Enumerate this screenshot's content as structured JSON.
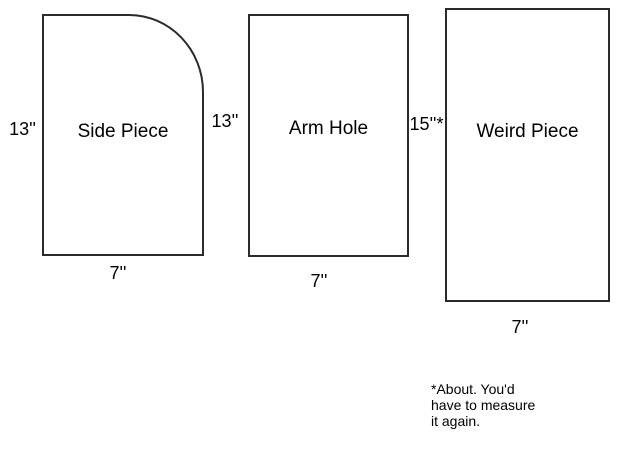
{
  "diagram": {
    "title": "sewing pattern pieces",
    "colors": {
      "line": "#2b2b2b",
      "text": "#000000",
      "background": "#ffffff"
    },
    "pieces": [
      {
        "name": "Side Piece",
        "height_label": "13''",
        "width_label": "7''",
        "shape": "rectangle with rounded top-right corner"
      },
      {
        "name": "Arm Hole",
        "height_label": "13''",
        "width_label": "7''",
        "shape": "rectangle"
      },
      {
        "name": "Weird Piece",
        "height_label": "15''*",
        "width_label": "7''",
        "shape": "rectangle"
      }
    ],
    "footnote": "*About. You'd\nhave to measure\nit again."
  }
}
